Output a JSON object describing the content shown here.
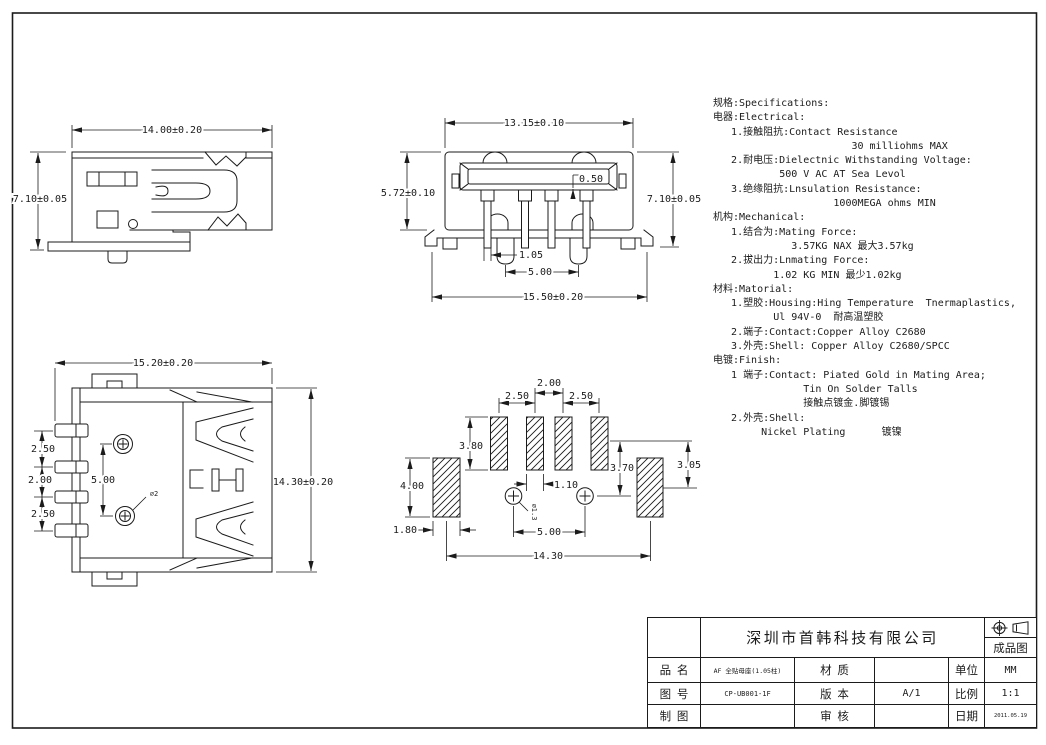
{
  "page": {
    "background": "#ffffff",
    "line_color": "#1b1b1b"
  },
  "specs": {
    "lines": [
      "规格:Specifications:",
      "电器:Electrical:",
      "   1.接触阻抗:Contact Resistance",
      "                       30 milliohms MAX",
      "   2.耐电压:Dielectnic Withstanding Voltage:",
      "           500 V AC AT Sea Levol",
      "   3.绝缘阻抗:Lnsulation Resistance:",
      "                    1000MEGA ohms MIN",
      "机构:Mechanical:",
      "   1.结合为:Mating Force:",
      "             3.57KG NAX 最大3.57kg",
      "   2.拔出力:Lnmating Force:",
      "          1.02 KG MIN 最少1.02kg",
      "材料:Matorial:",
      "   1.塑胶:Housing:Hing Temperature  Tnermaplastics,",
      "          Ul 94V-0  耐高温塑胶",
      "   2.端子:Contact:Copper Alloy C2680",
      "   3.外壳:Shell: Copper Alloy C2680/SPCC",
      "电镀:Finish:",
      "   1 端子:Contact: Piated Gold in Mating Area;",
      "               Tin On Solder Talls",
      "               接触点镀金.脚镀锡",
      "   2.外壳:Shell:",
      "        Nickel Plating      镀镍"
    ]
  },
  "views": {
    "side": {
      "width": "14.00±0.20",
      "height": "7.10±0.05"
    },
    "front": {
      "width_top": "13.15±0.10",
      "height_left": "5.72±0.10",
      "height_right": "7.10±0.05",
      "tongue_gap": "0.50",
      "pin_width": "1.05",
      "post_pitch": "5.00",
      "width_bottom": "15.50±0.20"
    },
    "top": {
      "width": "15.20±0.20",
      "height": "14.30±0.20",
      "pitch_a": "2.50",
      "pitch_b": "2.00",
      "pitch_c": "2.50",
      "post_pitch": "5.00",
      "post_dia": "∅2"
    },
    "footprint": {
      "pitch_center": "2.00",
      "pitch_left": "2.50",
      "pitch_right": "2.50",
      "pad_length": "3.80",
      "shell_pad_length": "4.00",
      "shell_pad_width": "1.80",
      "pad_width": "1.10",
      "hole_offset": "3.70",
      "shell_pad_offset": "3.05",
      "hole_pitch": "5.00",
      "overall_width": "14.30",
      "hole_dia": "∅1.3"
    }
  },
  "title_block": {
    "company": "深圳市首韩科技有限公司",
    "drawing_type": "成品图",
    "projection_icons": [
      "target-circle-icon",
      "cone-icon"
    ],
    "fields": {
      "part_name_label": "品  名",
      "part_name": "AF 全贴母座(1.05柱)",
      "material_label": "材  质",
      "material": "",
      "unit_label": "单位",
      "unit": "MM",
      "drawing_no_label": "图  号",
      "drawing_no": "CP-UB001-1F",
      "version_label": "版  本",
      "version": "A/1",
      "scale_label": "比例",
      "scale": "1:1",
      "drawn_by_label": "制  图",
      "drawn_by": "",
      "checked_label": "审  核",
      "checked": "",
      "date_label": "日期",
      "date": "2011.05.19"
    }
  }
}
